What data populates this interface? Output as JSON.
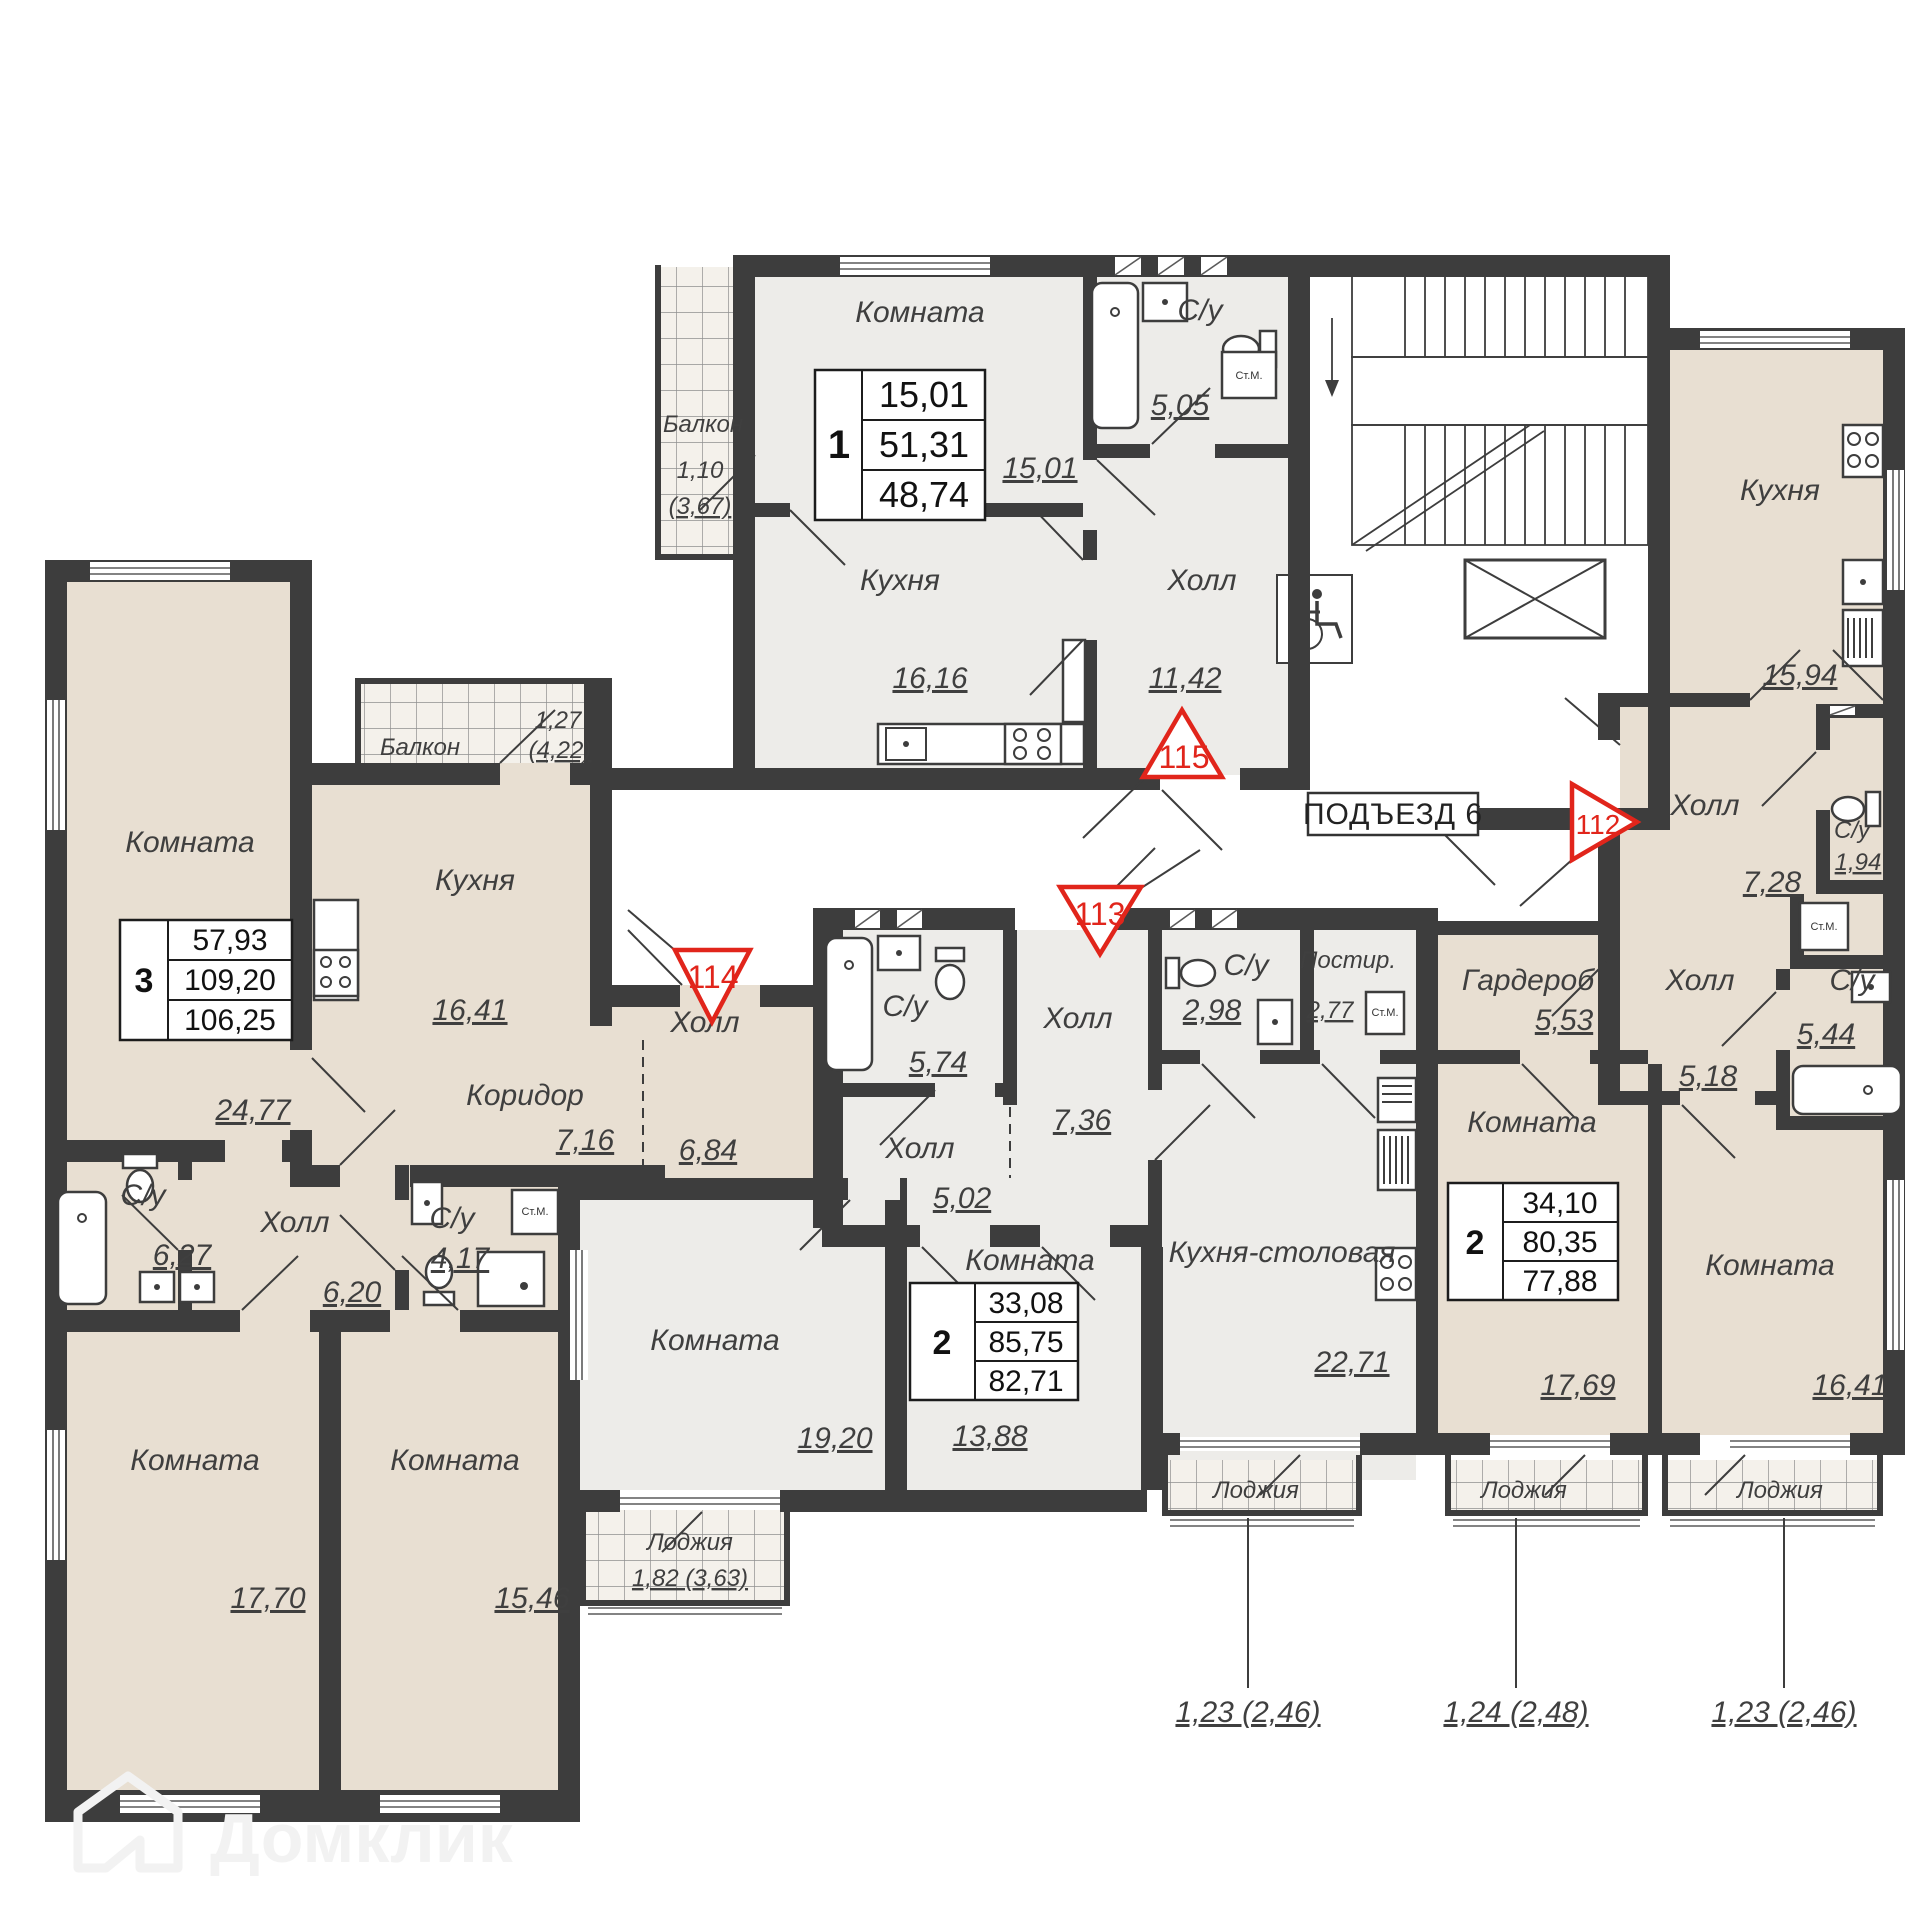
{
  "plan": {
    "entrance_sign": "ПОДЪЕЗД 6",
    "watermark": "Домклик",
    "callouts": [
      "1,23 (2,46)",
      "1,24 (2,48)",
      "1,23 (2,46)"
    ],
    "colors": {
      "wall": "#3d3d3d",
      "room_light": "#edece9",
      "room_beige": "#e8dfd2",
      "balcony": "#f4f1eb",
      "marker_red": "#e1251b"
    },
    "units": {
      "u115": {
        "marker": "115",
        "type": "1",
        "living": "15,01",
        "total": "51,31",
        "reduced": "48,74",
        "rooms": {
          "balcony": {
            "name": "Балкон",
            "v1": "1,10",
            "v2": "(3,67)"
          },
          "room": {
            "name": "Комната",
            "dim": "15,01"
          },
          "bath": {
            "name": "С/у",
            "dim": "5,05"
          },
          "kitchen": {
            "name": "Кухня",
            "dim": "16,16"
          },
          "hall": {
            "name": "Холл",
            "dim": "11,42"
          },
          "washer": "Ст.М."
        }
      },
      "u114": {
        "marker": "114",
        "type": "3",
        "living": "57,93",
        "total": "109,20",
        "reduced": "106,25",
        "rooms": {
          "room1": {
            "name": "Комната",
            "dim": "24,77"
          },
          "balcony": {
            "name": "Балкон",
            "v1": "1,27",
            "v2": "(4,22)"
          },
          "kitchen": {
            "name": "Кухня",
            "dim": "16,41"
          },
          "corridor": {
            "name": "Коридор",
            "dim": "7,16"
          },
          "hall": {
            "name": "Холл",
            "dim": "6,84"
          },
          "bath1": {
            "name": "С/у",
            "dim": "6,27"
          },
          "hall2": {
            "name": "Холл",
            "dim": "6,20"
          },
          "bath2": {
            "name": "С/у",
            "dim": "4,17"
          },
          "washer": "Ст.М.",
          "room2": {
            "name": "Комната",
            "dim": "17,70"
          },
          "room3": {
            "name": "Комната",
            "dim": "15,46"
          }
        }
      },
      "u113": {
        "marker": "113",
        "type": "2",
        "living": "33,08",
        "total": "85,75",
        "reduced": "82,71",
        "rooms": {
          "bath1": {
            "name": "С/у",
            "dim": "5,74"
          },
          "hall1": {
            "name": "Холл",
            "dim": "5,02"
          },
          "hall2": {
            "name": "Холл",
            "dim": "7,36"
          },
          "bath2": {
            "name": "С/у",
            "dim": "2,98"
          },
          "laundry": {
            "name": "Постир.",
            "dim": "2,77"
          },
          "washer": "Ст.М.",
          "kitchen": {
            "name": "Кухня-столовая",
            "dim": "22,71"
          },
          "room1": {
            "name": "Комната",
            "dim": "19,20"
          },
          "room2": {
            "name": "Комната",
            "dim": "13,88"
          },
          "loggia1": {
            "name": "Лоджия",
            "v": "1,82 (3,63)"
          },
          "loggia2": {
            "name": "Лоджия"
          }
        }
      },
      "u112": {
        "marker": "112",
        "type": "2",
        "living": "34,10",
        "total": "80,35",
        "reduced": "77,88",
        "rooms": {
          "kitchen": {
            "name": "Кухня",
            "dim": "15,94"
          },
          "hall1": {
            "name": "Холл",
            "dim": "7,28"
          },
          "bath1": {
            "name": "С/у",
            "dim": "1,94"
          },
          "washer": "Ст.М.",
          "hall2": {
            "name": "Холл",
            "dim": "5,18"
          },
          "bath2": {
            "name": "С/у",
            "dim": "5,44"
          },
          "wardrobe": {
            "name": "Гардероб",
            "dim": "5,53"
          },
          "room1": {
            "name": "Комната",
            "dim": "17,69"
          },
          "room2": {
            "name": "Комната",
            "dim": "16,41"
          },
          "loggia1": {
            "name": "Лоджия"
          },
          "loggia2": {
            "name": "Лоджия"
          }
        }
      }
    }
  }
}
